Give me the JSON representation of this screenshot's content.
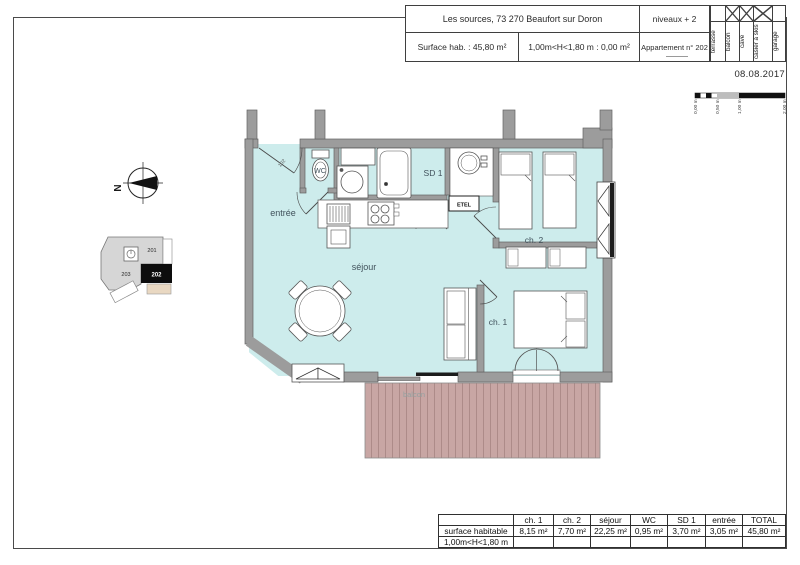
{
  "title_block": {
    "address": "Les sources, 73 270 Beaufort sur Doron",
    "level": "niveaux + 2",
    "surface_hab_label": "Surface hab. :  45,80 m²",
    "height_clause": "1,00m<H<1,80 m : 0,00 m²",
    "apartment": "Appartement n° 202",
    "amenity_columns": [
      {
        "label": "terrasse",
        "crossed": false
      },
      {
        "label": "balcon",
        "crossed": true
      },
      {
        "label": "cave",
        "crossed": true
      },
      {
        "label": "casier à skis",
        "crossed": true
      },
      {
        "label": "garage",
        "crossed": false
      }
    ],
    "date": "08.08.2017"
  },
  "scale_bar": {
    "tick_labels": [
      "0,00 m",
      "0,50 m",
      "1,00 m",
      "2,00 m"
    ]
  },
  "compass": {
    "north_label": "N"
  },
  "key_plan": {
    "units": [
      {
        "id": "201",
        "current": false
      },
      {
        "id": "203",
        "current": false
      },
      {
        "id": "202",
        "current": true
      }
    ]
  },
  "plan": {
    "rooms": [
      {
        "name": "entrée",
        "area": "3,05 m²"
      },
      {
        "name": "WC",
        "area": "0,95 m²"
      },
      {
        "name": "SD 1",
        "area": "3,70 m²"
      },
      {
        "name": "séjour",
        "area": "22,25 m²"
      },
      {
        "name": "ch. 2",
        "area": "7,70 m²"
      },
      {
        "name": "ch. 1",
        "area": "8,15 m²"
      }
    ],
    "balcony_label": "balcon",
    "technical_label": "ETEL",
    "entry_door_label": "102"
  },
  "area_table": {
    "col_headers": [
      "",
      "ch. 1",
      "ch. 2",
      "séjour",
      "WC",
      "SD 1",
      "entrée",
      "TOTAL"
    ],
    "rows": [
      {
        "label": "surface habitable",
        "values": [
          "8,15 m²",
          "7,70 m²",
          "22,25 m²",
          "0,95 m²",
          "3,70 m²",
          "3,05 m²",
          "45,80 m²"
        ]
      },
      {
        "label": "1,00m<H<1,80 m",
        "values": [
          "",
          "",
          "",
          "",
          "",
          "",
          ""
        ]
      }
    ]
  },
  "colors": {
    "room_fill": "#cdecec",
    "wall": "#9c9c9c",
    "balcony_fill": "#c8a6a4",
    "plan_label": "#41525c",
    "current_unit_fill": "#111111",
    "key_plan_fill": "#d6d6d6",
    "key_plan_balcony_fill": "#e9d8c2"
  }
}
